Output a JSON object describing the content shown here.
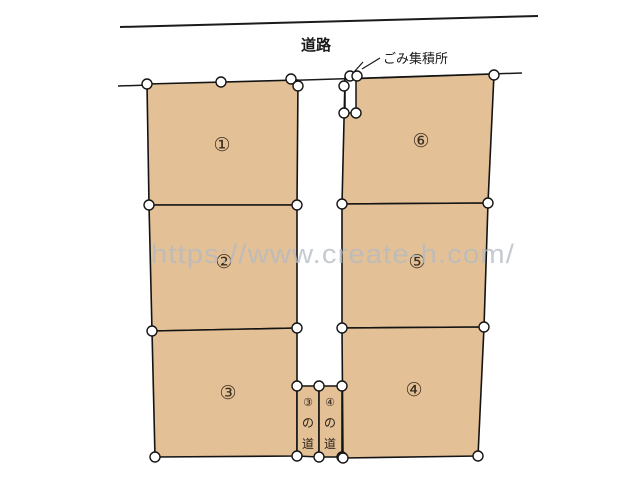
{
  "road": {
    "label": "道路"
  },
  "garbage_station": {
    "label": "ごみ集積所"
  },
  "watermark": {
    "text": "https://www.create-h.com/"
  },
  "plots": [
    {
      "number": "①"
    },
    {
      "number": "②"
    },
    {
      "number": "③"
    },
    {
      "number": "④"
    },
    {
      "number": "⑤"
    },
    {
      "number": "⑥"
    }
  ],
  "access_paths": [
    {
      "chars": [
        "③",
        "の",
        "道"
      ]
    },
    {
      "chars": [
        "④",
        "の",
        "道"
      ]
    }
  ],
  "colors": {
    "lot_fill": "#e4c096",
    "outline": "#141414",
    "marker_fill": "#ffffff",
    "watermark_gray": "#b3bac3",
    "background": "#ffffff"
  }
}
